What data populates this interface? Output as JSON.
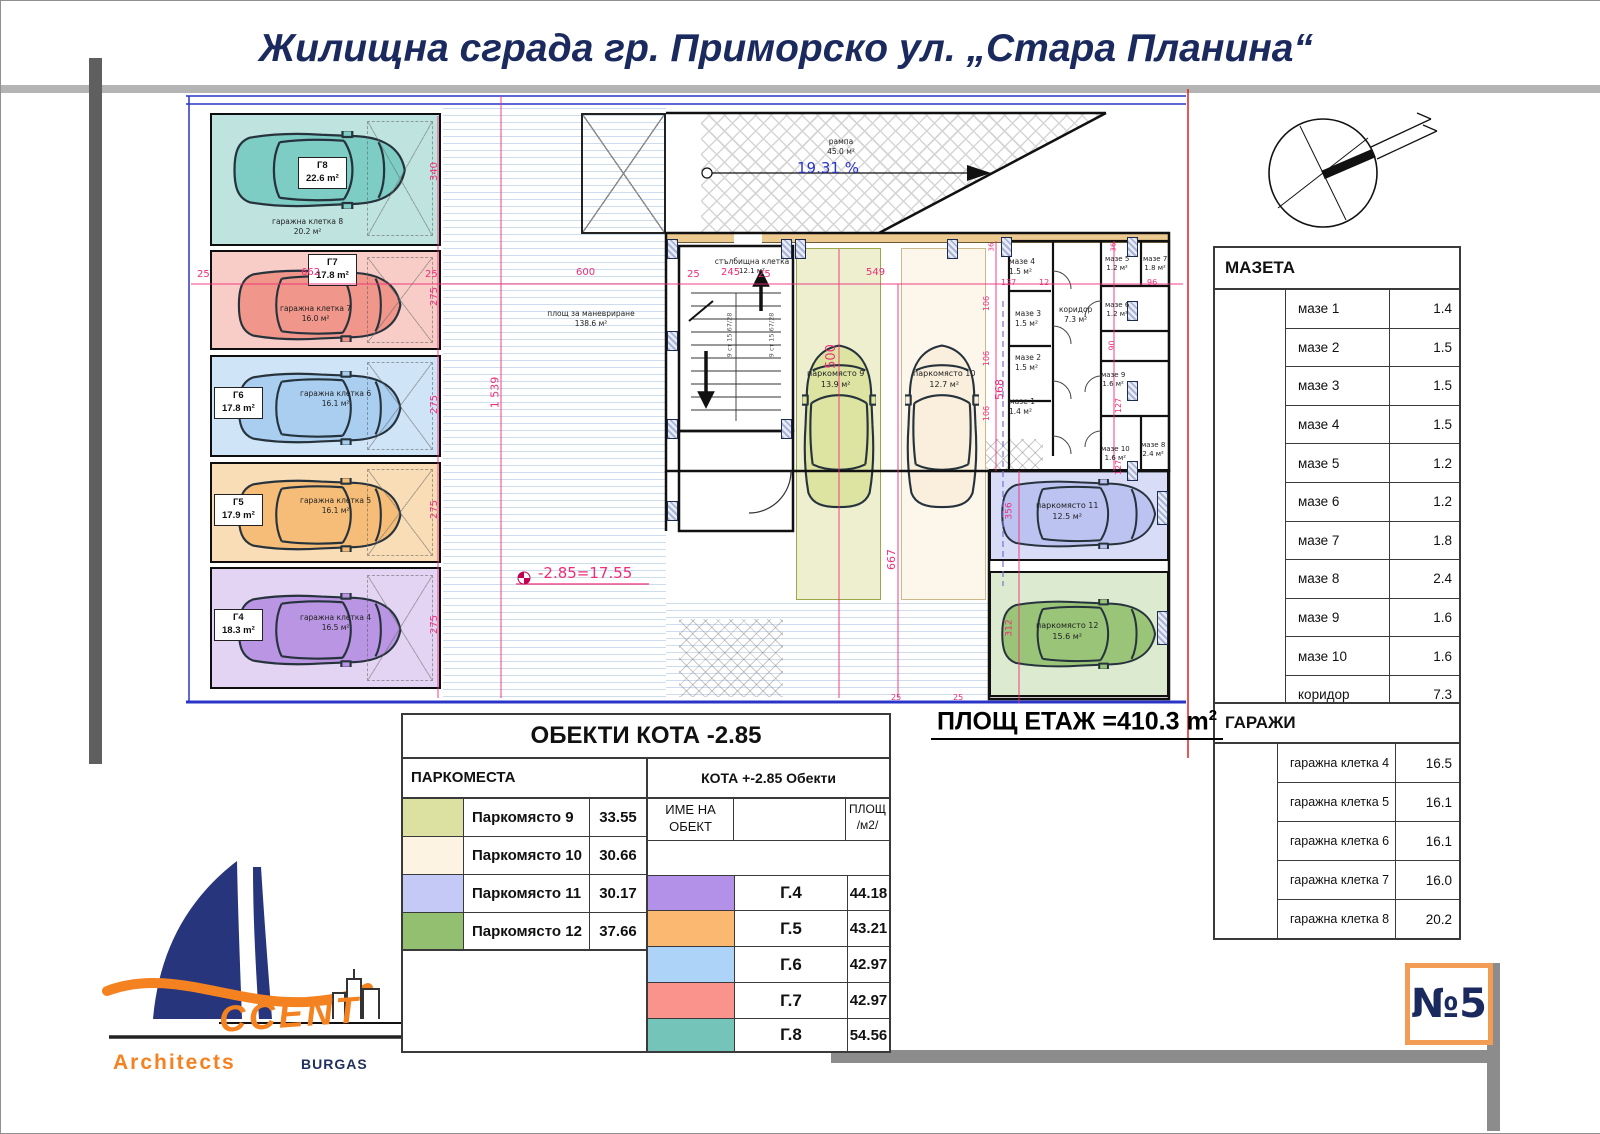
{
  "title": "Жилищна сграда гр. Приморско ул. „Стара Планина“",
  "colors": {
    "accent_navy": "#1b2a5e",
    "dim_pink": "#ee2e78",
    "line_blue": "#2a35c8",
    "boundary_red": "#e02020",
    "badge_orange": "#f29c55",
    "logo_orange": "#f58220"
  },
  "plan": {
    "ramp": {
      "name": "рампа",
      "area": "45.0 м²",
      "slope": "19.31 %"
    },
    "maneuver": {
      "name": "площ за маневриране",
      "area": "138.6 м²"
    },
    "stair": {
      "name": "стълбищна клетка",
      "area": "12.1 м²",
      "flight_note": "9 ст 15.67/28"
    },
    "level_mark": "-2.85=17.55",
    "garages": [
      {
        "code": "Г8",
        "area": "22.6 m²",
        "cell": "гаражна клетка 8",
        "cell_area": "20.2 м²",
        "color": "#7ecdc4",
        "bg": "#bfe4e0"
      },
      {
        "code": "Г7",
        "area": "17.8 m²",
        "cell": "гаражна клетка 7",
        "cell_area": "16.0 м²",
        "color": "#f0968b",
        "bg": "#f8cdc7"
      },
      {
        "code": "Г6",
        "area": "17.8 m²",
        "cell": "гаражна клетка 6",
        "cell_area": "16.1 м²",
        "color": "#a9cef0",
        "bg": "#cfe4f6"
      },
      {
        "code": "Г5",
        "area": "17.9 m²",
        "cell": "гаражна клетка 5",
        "cell_area": "16.1 м²",
        "color": "#f6bd79",
        "bg": "#f9ddb7"
      },
      {
        "code": "Г4",
        "area": "18.3 m²",
        "cell": "гаражна клетка 4",
        "cell_area": "16.5 м²",
        "color": "#b995e3",
        "bg": "#e4d4f3"
      }
    ],
    "parking": [
      {
        "name": "паркомясто 9",
        "area": "13.9 м²",
        "color": "#dde4a2",
        "bg": "#edefcf"
      },
      {
        "name": "паркомясто 10",
        "area": "12.7 м²",
        "color": "#f9efdc",
        "bg": "#fdf6ea"
      },
      {
        "name": "паркомясто 11",
        "area": "12.5 м²",
        "color": "#bcc3f0",
        "bg": "#d9dcf7"
      },
      {
        "name": "паркомясто 12",
        "area": "15.6 м²",
        "color": "#9ac478",
        "bg": "#dcead0"
      }
    ],
    "rooms": [
      {
        "name": "мазе 4",
        "area": "1.5 м²"
      },
      {
        "name": "мазе 3",
        "area": "1.5 м²"
      },
      {
        "name": "мазе 2",
        "area": "1.5 м²"
      },
      {
        "name": "мазе 1",
        "area": "1.4 м²"
      },
      {
        "name": "мазе 5",
        "area": "1.2 м²"
      },
      {
        "name": "мазе 7",
        "area": "1.8 м²"
      },
      {
        "name": "мазе 6",
        "area": "1.2 м²"
      },
      {
        "name": "коридор",
        "area": "7.3 м²"
      },
      {
        "name": "мазе 9",
        "area": "1.6 м²"
      },
      {
        "name": "мазе 10",
        "area": "1.6 м²"
      },
      {
        "name": "мазе 8",
        "area": "2.4 м²"
      }
    ],
    "dims": [
      "25",
      "662",
      "25",
      "600",
      "25",
      "245",
      "25",
      "549",
      "137",
      "12",
      "96",
      "1 539",
      "340",
      "275",
      "275",
      "275",
      "275",
      "500",
      "667",
      "568",
      "106",
      "106",
      "106",
      "90",
      "127",
      "127",
      "356",
      "312",
      "36",
      "36",
      "25",
      "25"
    ]
  },
  "floor_area": {
    "text": "ПЛОЩ ЕТАЖ =410.3 m",
    "sup": "2"
  },
  "mazeta_table": {
    "title": "МАЗЕТА",
    "rows": [
      {
        "label": "мазе 1",
        "value": "1.4"
      },
      {
        "label": "мазе 2",
        "value": "1.5"
      },
      {
        "label": "мазе 3",
        "value": "1.5"
      },
      {
        "label": "мазе 4",
        "value": "1.5"
      },
      {
        "label": "мазе 5",
        "value": "1.2"
      },
      {
        "label": "мазе 6",
        "value": "1.2"
      },
      {
        "label": "мазе 7",
        "value": "1.8"
      },
      {
        "label": "мазе 8",
        "value": "2.4"
      },
      {
        "label": "мазе 9",
        "value": "1.6"
      },
      {
        "label": "мазе 10",
        "value": "1.6"
      },
      {
        "label": "коридор",
        "value": "7.3"
      }
    ]
  },
  "garage_table": {
    "title": "ГАРАЖИ",
    "rows": [
      {
        "label": "гаражна клетка 4",
        "value": "16.5"
      },
      {
        "label": "гаражна клетка 5",
        "value": "16.1"
      },
      {
        "label": "гаражна клетка 6",
        "value": "16.1"
      },
      {
        "label": "гаражна клетка 7",
        "value": "16.0"
      },
      {
        "label": "гаражна клетка 8",
        "value": "20.2"
      }
    ]
  },
  "objects_table": {
    "title": "ОБЕКТИ КОТА -2.85",
    "left_header": "ПАРКОМЕСТА",
    "right_header": "КОТА +-2.85 Обекти",
    "name_col_line1": "ИМЕ НА",
    "name_col_line2": "ОБЕКТ",
    "area_col_line1": "ПЛОЩ",
    "area_col_line2": "/м2/",
    "parking_rows": [
      {
        "label": "Паркомясто 9",
        "value": "33.55",
        "color": "#dce0a0"
      },
      {
        "label": "Паркомясто 10",
        "value": "30.66",
        "color": "#fdf3e3"
      },
      {
        "label": "Паркомясто 11",
        "value": "30.17",
        "color": "#c4caf5"
      },
      {
        "label": "Паркомясто 12",
        "value": "37.66",
        "color": "#92bf70"
      }
    ],
    "object_rows": [
      {
        "label": "Г.4",
        "value": "44.18",
        "color": "#b491e9"
      },
      {
        "label": "Г.5",
        "value": "43.21",
        "color": "#fab871"
      },
      {
        "label": "Г.6",
        "value": "42.97",
        "color": "#aed3f8"
      },
      {
        "label": "Г.7",
        "value": "42.97",
        "color": "#f9938b"
      },
      {
        "label": "Г.8",
        "value": "54.56",
        "color": "#74c4b9"
      }
    ]
  },
  "badge": "№5",
  "logo": {
    "accent": "CCENT",
    "architects": "Architects",
    "city": "BURGAS"
  }
}
